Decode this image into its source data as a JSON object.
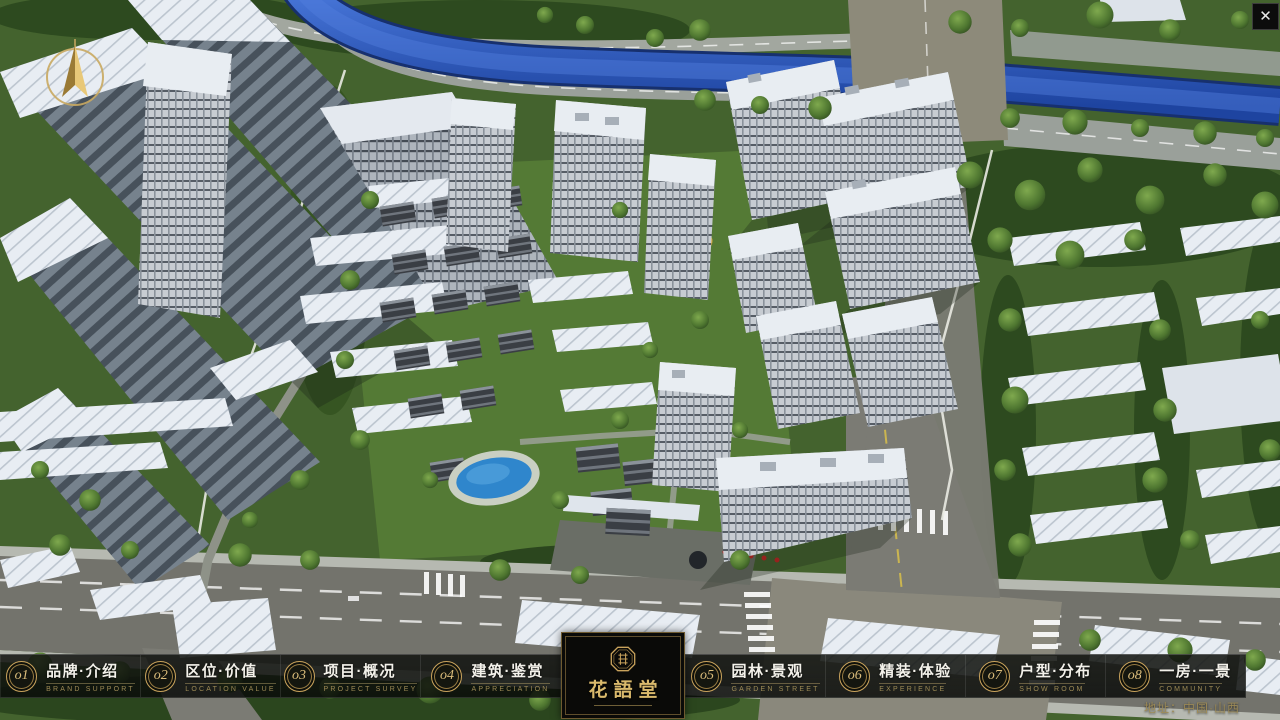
{
  "app": {
    "close_glyph": "✕"
  },
  "palette": {
    "accent_gold": "#c9a35c",
    "gold_text_dim": "#9d8a55",
    "bar_background": "rgba(10,12,10,0.85)",
    "label_white": "#f3f1ea",
    "logo_background": "#0a0a08",
    "water_blue": "#2e5ec4",
    "grass_green": "#44632e",
    "road_gray": "#8b8d86"
  },
  "icons": {
    "close": "close-icon",
    "compass": "compass-north-icon",
    "brand_seal": "octagonal-seal-icon"
  },
  "nav": {
    "items": [
      {
        "num": "o1",
        "zh": "品牌·介绍",
        "en": "BRAND SUPPORT"
      },
      {
        "num": "o2",
        "zh": "区位·价值",
        "en": "LOCATION VALUE"
      },
      {
        "num": "o3",
        "zh": "项目·概况",
        "en": "PROJECT SURVEY"
      },
      {
        "num": "o4",
        "zh": "建筑·鉴赏",
        "en": "APPRECIATION"
      },
      {
        "num": "o5",
        "zh": "园林·景观",
        "en": "GARDEN STREET"
      },
      {
        "num": "o6",
        "zh": "精装·体验",
        "en": "EXPERIENCE"
      },
      {
        "num": "o7",
        "zh": "户型·分布",
        "en": "SHOW ROOM"
      },
      {
        "num": "o8",
        "zh": "一房·一景",
        "en": "COMMUNITY"
      }
    ]
  },
  "logo": {
    "title": "花語堂"
  },
  "footer": {
    "address": "地址：中国·山西"
  }
}
